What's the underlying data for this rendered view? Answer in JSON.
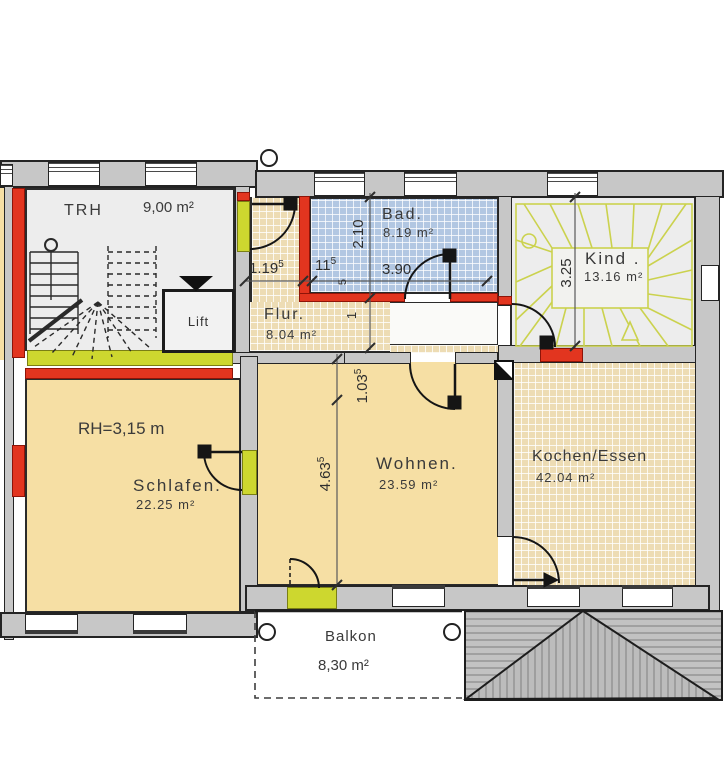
{
  "title": "Obergeschoss Grundriss",
  "rooms": {
    "trh": {
      "name": "TRH",
      "area": "9,00 m²"
    },
    "bad": {
      "name": "Bad.",
      "area": "8.19 m²"
    },
    "kind": {
      "name": "Kind .",
      "area": "13.16 m²"
    },
    "flur": {
      "name": "Flur.",
      "area": "8.04 m²"
    },
    "lift": {
      "name": "Lift"
    },
    "schlafen": {
      "name": "Schlafen.",
      "area": "22.25 m²",
      "rh": "RH=3,15 m"
    },
    "wohnen": {
      "name": "Wohnen.",
      "area": "23.59 m²"
    },
    "kochen": {
      "name": "Kochen/Essen",
      "area": "42.04 m²"
    },
    "balkon": {
      "name": "Balkon",
      "area": "8,30 m²"
    }
  },
  "dimensions": {
    "h_flur": {
      "value": "1.19",
      "sup": "5"
    },
    "h_wall": {
      "value": "11",
      "sup": "5"
    },
    "h_bad": {
      "value": "3.90",
      "sup": ""
    },
    "v_bad": {
      "value": "2.10",
      "sup": ""
    },
    "v_bad_sub": {
      "value": "5"
    },
    "v_one": {
      "value": "1"
    },
    "v_recess": {
      "value": "1.03",
      "sup": "5"
    },
    "v_wohnen": {
      "value": "4.63",
      "sup": "5"
    },
    "v_kind": {
      "value": "3.25",
      "sup": ""
    }
  },
  "colors": {
    "wall": "#c7c7c7",
    "radiator_red": "#e2351f",
    "threshold_lime": "#cdd72f",
    "tile_beige": "#eddcb4",
    "tile_blue": "#b2c7e2",
    "room_beige": "#f6dfa4",
    "room_gray": "#ededed",
    "roof_gray": "#c2c2c2"
  }
}
